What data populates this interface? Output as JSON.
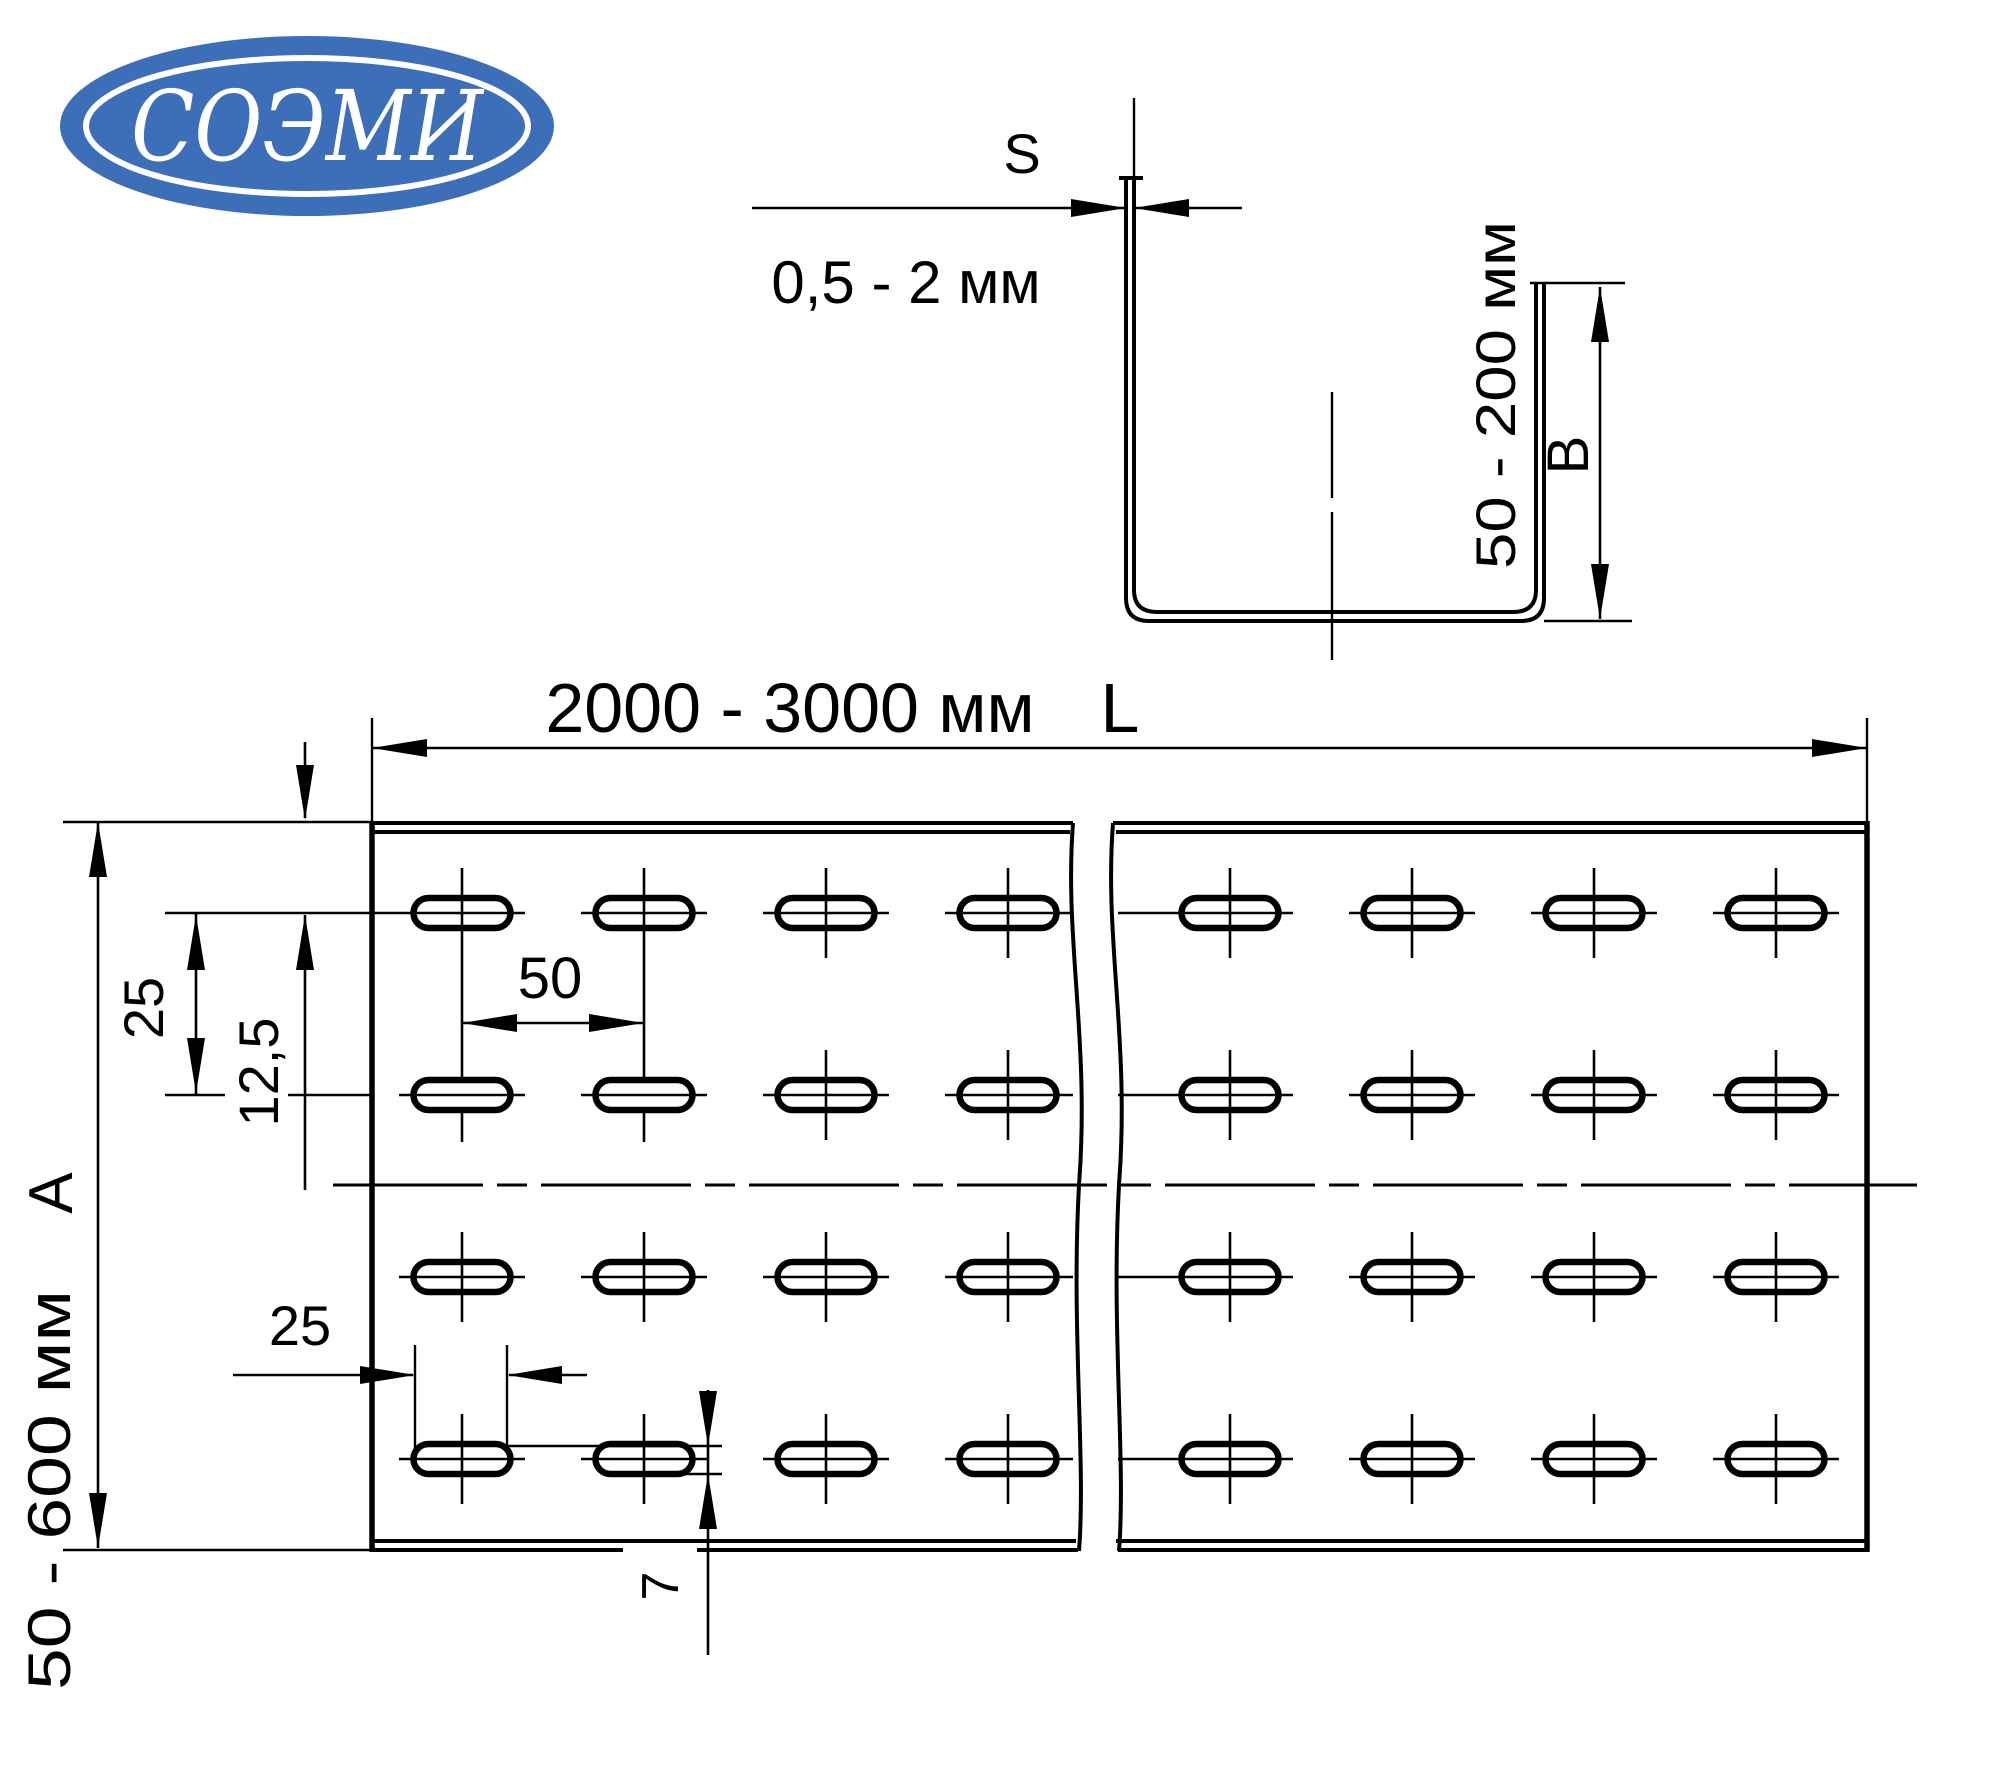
{
  "logo": {
    "text": "СОЭМИ",
    "bg_color": "#3d6eb8",
    "text_color": "#ffffff"
  },
  "section_view": {
    "thickness_symbol": "S",
    "thickness_range": "0,5 - 2 мм",
    "flange_height_range": "50 - 200 мм",
    "flange_height_symbol": "B"
  },
  "plan_view": {
    "length_range": "2000 - 3000 мм",
    "length_symbol": "L",
    "width_range": "50 - 600 мм",
    "width_symbol": "A",
    "row_spacing": "25",
    "row_center_offset": "12,5",
    "slot_pitch": "50",
    "slot_length": "25",
    "slot_width": "7"
  },
  "colors": {
    "line": "#000000",
    "logo_blue": "#3d6eb8",
    "background": "#ffffff"
  }
}
